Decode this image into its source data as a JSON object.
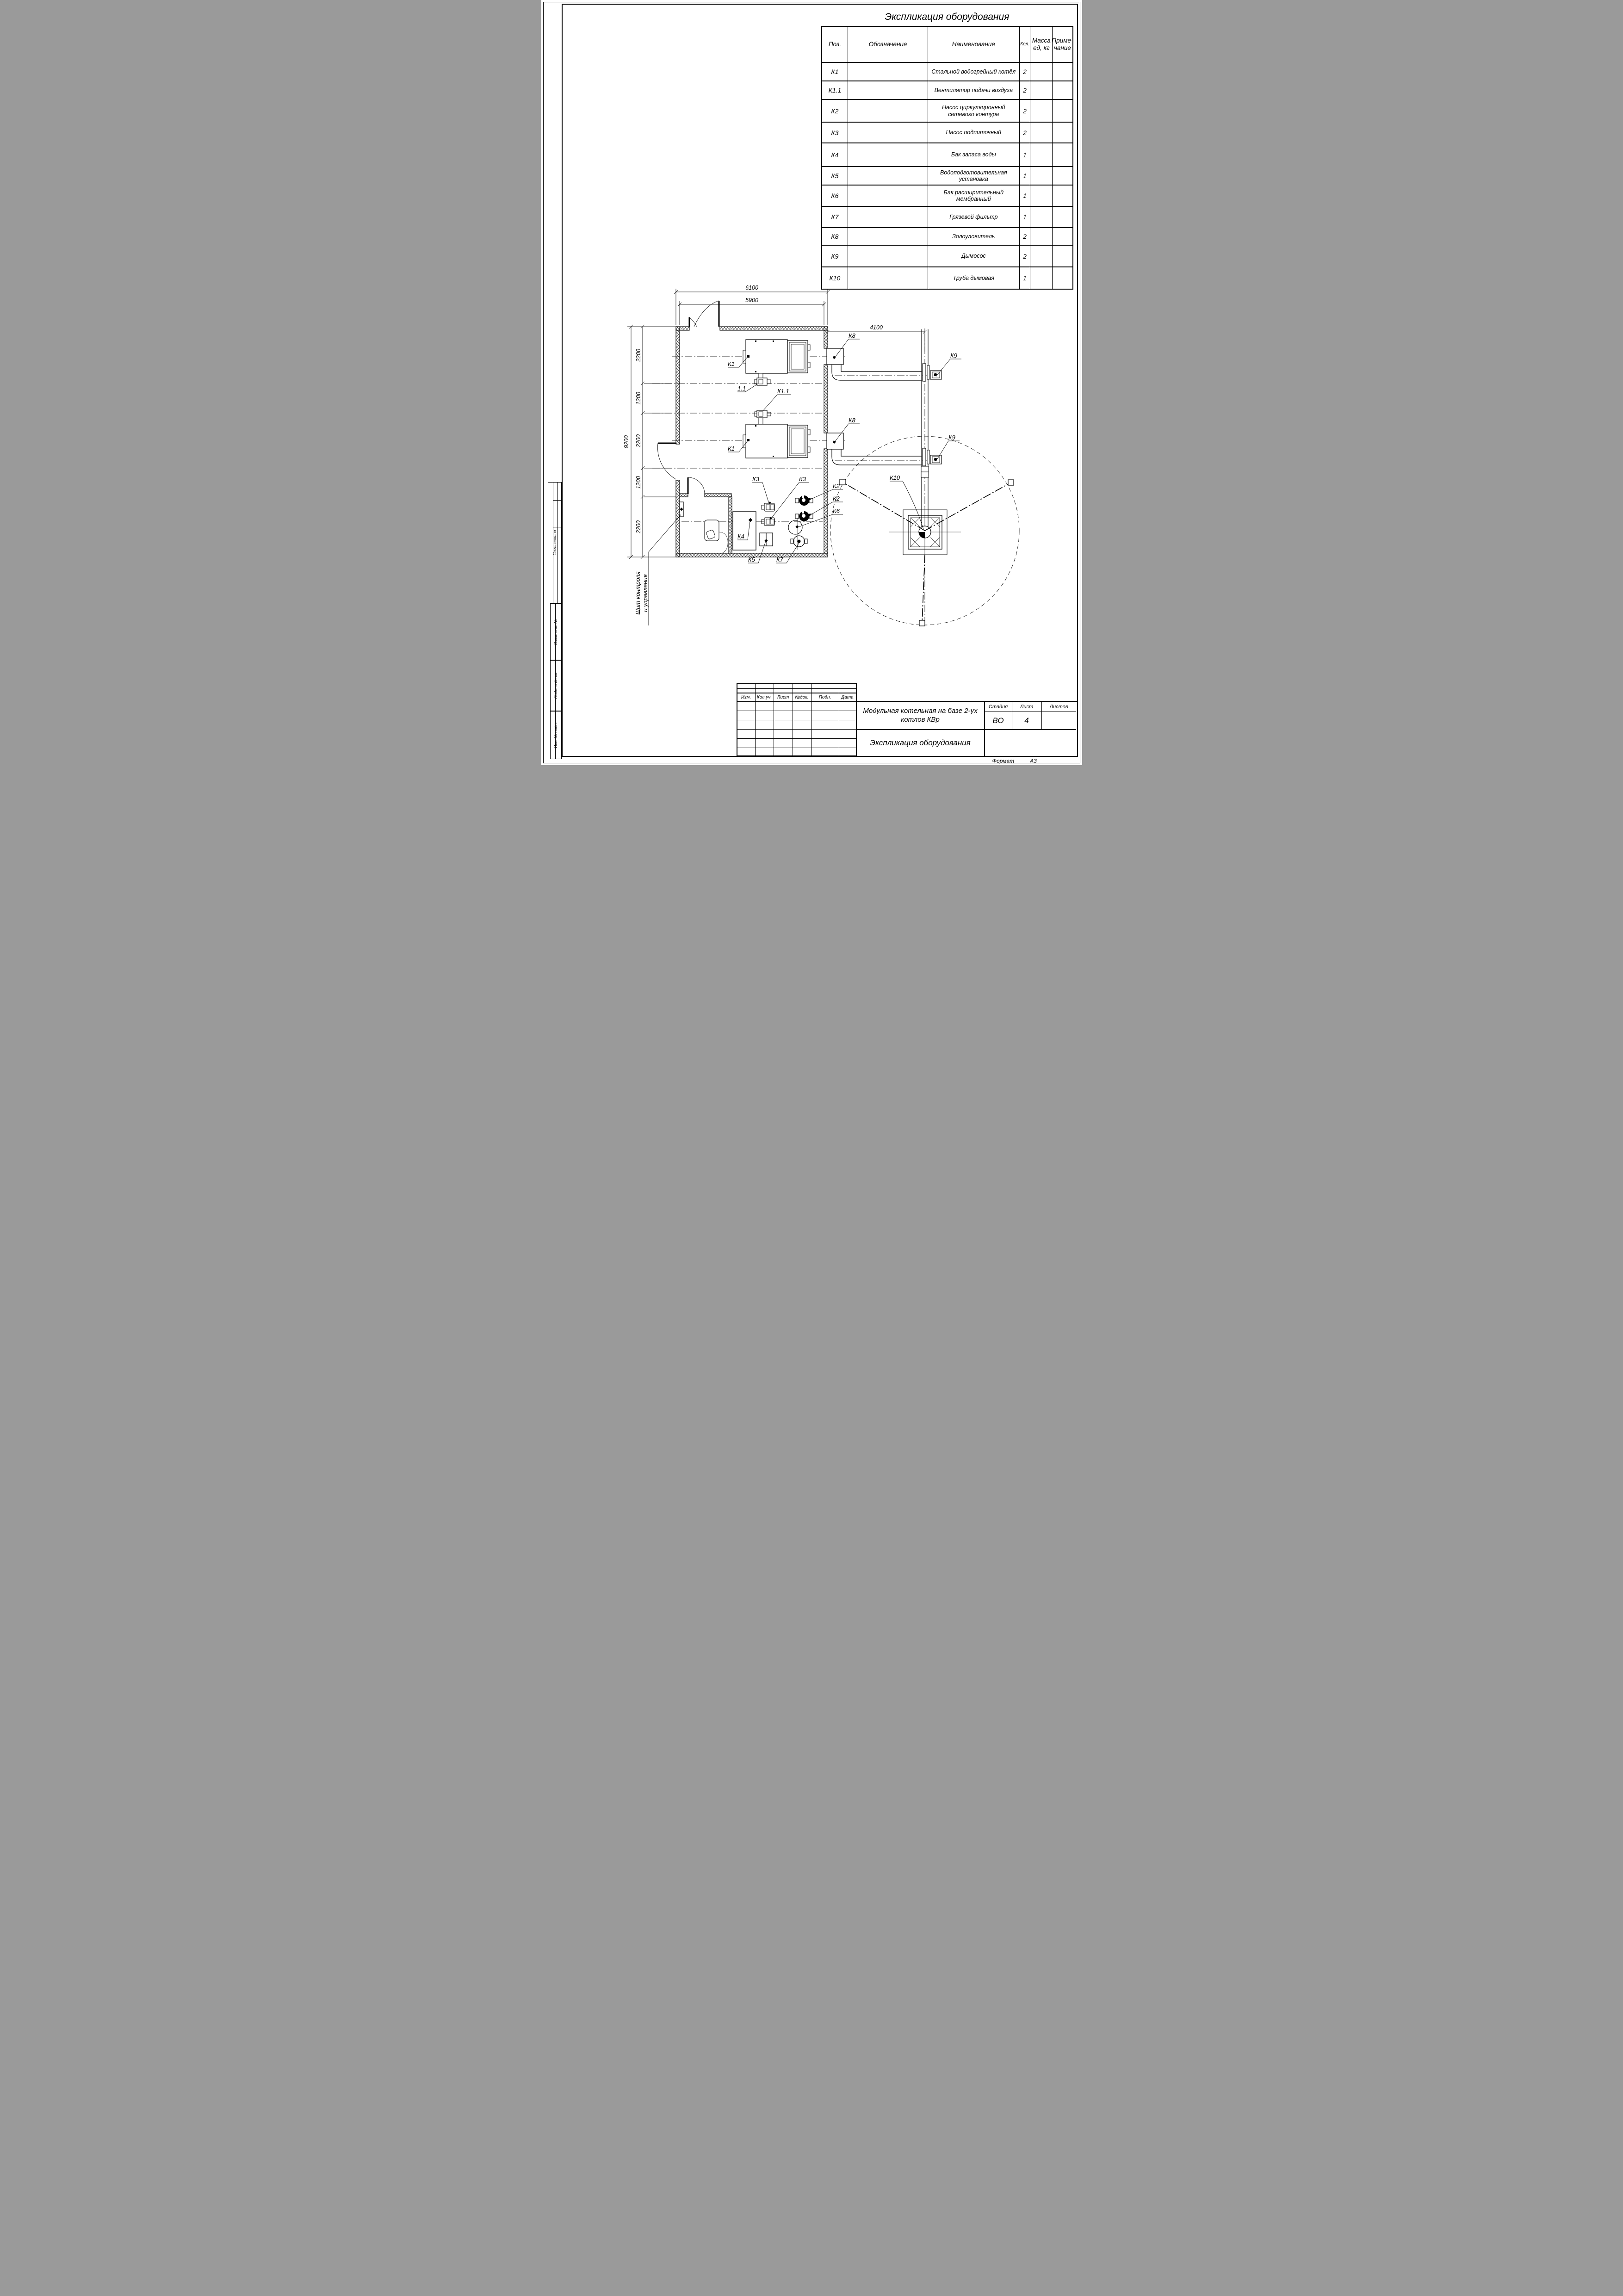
{
  "sheet": {
    "format_label": "Формат",
    "format_value": "А3"
  },
  "spec_table": {
    "title": "Экспликация оборудования",
    "headers": {
      "pos": "Поз.",
      "designation": "Обозначение",
      "name": "Наименование",
      "qty": "Кол.",
      "mass": "Масса ед, кг",
      "note": "Приме- чание"
    },
    "rows": [
      {
        "pos": "К1",
        "name": "Стальной водогрейный котёл",
        "qty": "2"
      },
      {
        "pos": "К1.1",
        "name": "Вентилятор подачи воздуха",
        "qty": "2"
      },
      {
        "pos": "К2",
        "name": "Насос циркуляционный сетевого контура",
        "qty": "2"
      },
      {
        "pos": "К3",
        "name": "Насос подпиточный",
        "qty": "2"
      },
      {
        "pos": "К4",
        "name": "Бак запаса воды",
        "qty": "1"
      },
      {
        "pos": "К5",
        "name": "Водоподготовительная установка",
        "qty": "1"
      },
      {
        "pos": "К6",
        "name": "Бак расширительный мембранный",
        "qty": "1"
      },
      {
        "pos": "К7",
        "name": "Грязевой фильтр",
        "qty": "1"
      },
      {
        "pos": "К8",
        "name": "Золоуловитель",
        "qty": "2"
      },
      {
        "pos": "К9",
        "name": "Дымосос",
        "qty": "2"
      },
      {
        "pos": "К10",
        "name": "Труба дымовая",
        "qty": "1"
      }
    ]
  },
  "plan": {
    "dims": {
      "overall_width": "6100",
      "inner_width": "5900",
      "chimney_offset": "4100",
      "overall_depth": "9200",
      "seg_a": "2200",
      "seg_b": "1200",
      "seg_c": "2200",
      "seg_d": "1200",
      "seg_e": "2200"
    },
    "labels": {
      "k1": "К1",
      "fan": "1.1",
      "k11": "К1.1",
      "k2": "К2",
      "k3": "К3",
      "k4": "К4",
      "k5": "К5",
      "k6": "К6",
      "k7": "К7",
      "k8": "К8",
      "k9": "К9",
      "k10": "К10"
    },
    "panel_label_line1": "Щит контроля",
    "panel_label_line2": "и управления"
  },
  "title_block": {
    "rev_headers": [
      "Изм.",
      "Кол.уч.",
      "Лист",
      "№док.",
      "Подп.",
      "Дата"
    ],
    "project": "Модульная котельная на базе 2-ух котлов КВр",
    "doc": "Экспликация оборудования",
    "stage_label": "Стадия",
    "stage": "ВО",
    "sheet_label": "Лист",
    "sheet": "4",
    "sheets_label": "Листов"
  },
  "stamps": [
    "Согласовано",
    "Взам. инв. №",
    "Подп. и дата",
    "Инв. № подл."
  ]
}
